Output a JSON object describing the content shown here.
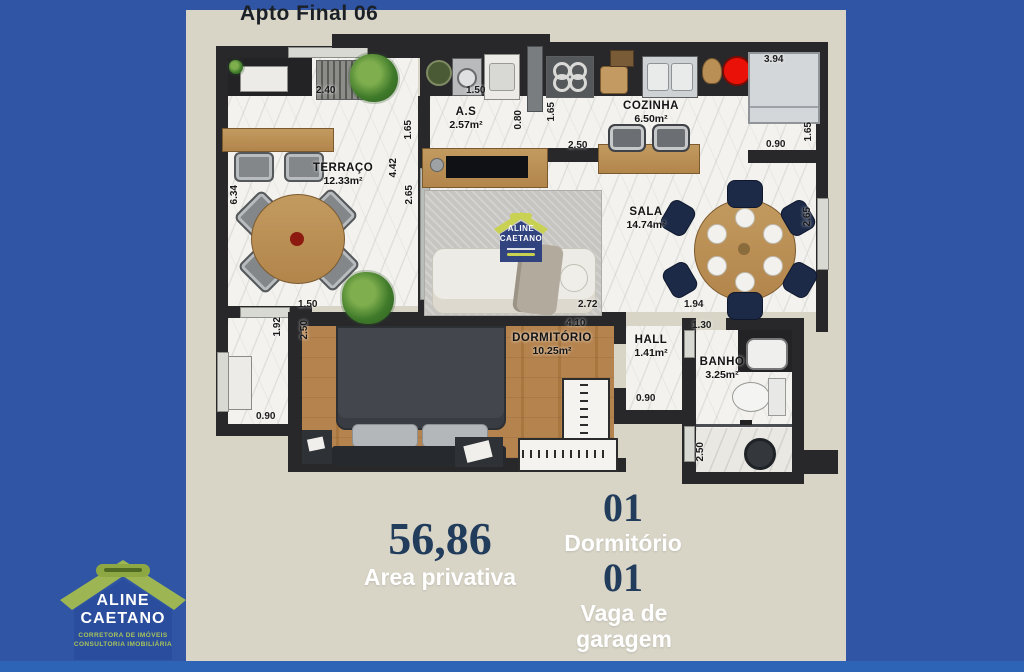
{
  "title": "Apto Final 06",
  "rooms": {
    "terraco": {
      "name": "TERRAÇO",
      "area": "12.33m²"
    },
    "servico": {
      "name": "A.S",
      "area": "2.57m²"
    },
    "cozinha": {
      "name": "COZINHA",
      "area": "6.50m²"
    },
    "sala": {
      "name": "SALA",
      "area": "14.74m²"
    },
    "dormitorio": {
      "name": "DORMITÓRIO",
      "area": "10.25m²"
    },
    "hall": {
      "name": "HALL",
      "area": "1.41m²"
    },
    "banho": {
      "name": "BANHO",
      "area": "3.25m²"
    }
  },
  "dims": {
    "d_240": "2.40",
    "d_150_top": "1.50",
    "d_394": "3.94",
    "d_634": "6.34",
    "d_165_as": "1.65",
    "d_080": "0.80",
    "d_165_coz": "1.65",
    "d_250_coz": "2.50",
    "d_442": "4.42",
    "d_265_tv": "2.65",
    "d_265_sala": "2.65",
    "d_090_right": "0.90",
    "d_165_right": "1.65",
    "d_150_terr": "1.50",
    "d_192": "1.92",
    "d_250_dorm": "2.50",
    "d_090_corr": "0.90",
    "d_272": "2.72",
    "d_410": "4.10",
    "d_194": "1.94",
    "d_130": "1.30",
    "d_090_hall": "0.90",
    "d_250_banho": "2.50"
  },
  "summary": {
    "area_value": "56,86",
    "area_label": "Area privativa",
    "bedroom_value": "01",
    "bedroom_label": "Dormitório",
    "garage_value": "01",
    "garage_label": "Vaga de garagem"
  },
  "logo": {
    "line1": "ALINE",
    "line2": "CAETANO",
    "tagline1": "CORRETORA DE IMÓVEIS",
    "tagline2": "CONSULTORIA IMOBILIÁRIA"
  },
  "colors": {
    "background_blue": "#2f55a4",
    "bottom_strip_blue": "#2d64b6",
    "sheet_beige": "#d8d5c7",
    "wall_dark": "#28282b",
    "wood_floor": "#b5834e",
    "accent_red": "#ea1208",
    "navy_number": "#223c5c",
    "chair_navy": "#1d2a47",
    "logo_green": "#9db653",
    "logo_blue": "#2a4e9d"
  }
}
